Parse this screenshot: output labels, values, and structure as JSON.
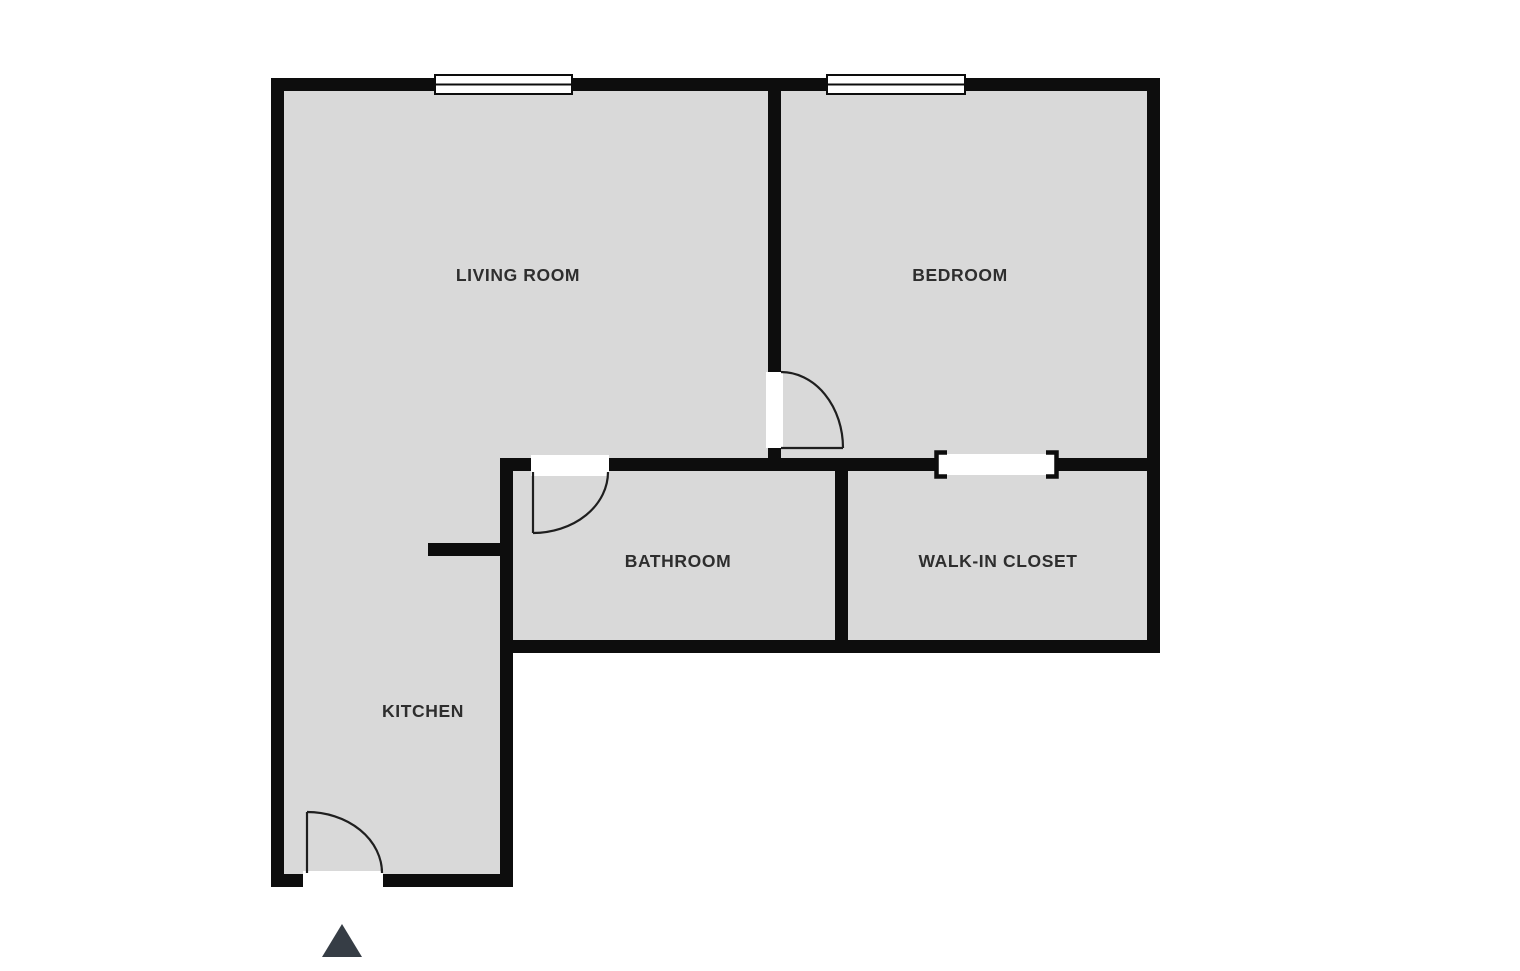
{
  "diagram_type": "floor-plan",
  "rooms": [
    {
      "label": "LIVING ROOM"
    },
    {
      "label": "BEDROOM"
    },
    {
      "label": "BATHROOM"
    },
    {
      "label": "WALK-IN CLOSET"
    },
    {
      "label": "KITCHEN"
    }
  ],
  "colors": {
    "background": "#ffffff",
    "floor": "#d9d9d9",
    "wall": "#0d0d0d",
    "label": "#2e2e2e",
    "door_swing": "#1f1f1f",
    "entrance_marker": "#363d45"
  },
  "symbols": {
    "windows": [
      "living-room-window",
      "bedroom-window"
    ],
    "doors": [
      "entrance-door",
      "bathroom-door",
      "bedroom-door"
    ],
    "openings": [
      "walk-in-closet-opening"
    ],
    "entrance_marker": "up-triangle"
  }
}
